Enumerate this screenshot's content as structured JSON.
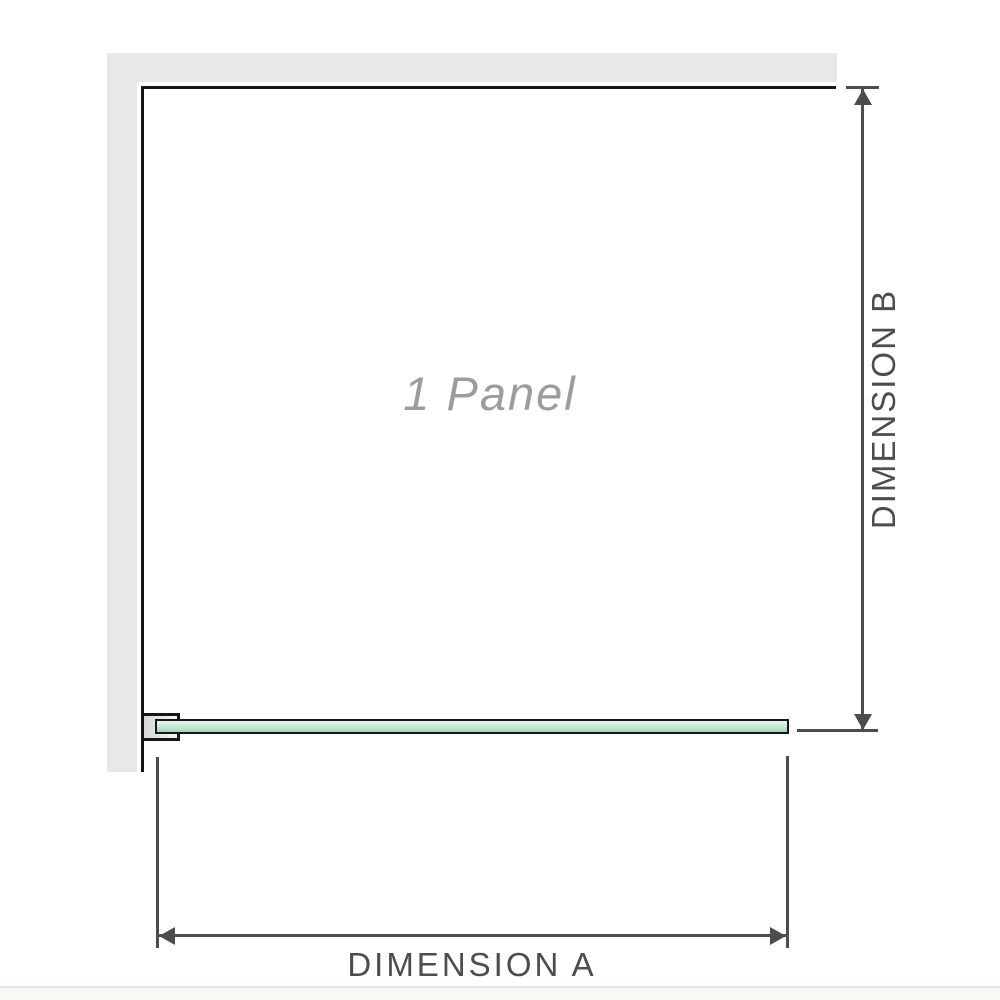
{
  "diagram": {
    "panel_label": "1 Panel",
    "dimensions": {
      "width_label": "DIMENSION A",
      "height_label": "DIMENSION B"
    }
  },
  "colors": {
    "wall": "#e8e8e8",
    "outline": "#161616",
    "dimension": "#4d4d4d",
    "panel_label": "#9c9c9c",
    "glass_light": "#e7f5ee",
    "glass_mid": "#c6e8d5",
    "glass_dark": "#9fd6b6",
    "bracket_inner_dark": "#d6d6d6",
    "bracket_inner_light": "#f5f5f5",
    "floor_line": "#e5e2db",
    "floor": "#faf8f5",
    "bg": "#ffffff"
  }
}
